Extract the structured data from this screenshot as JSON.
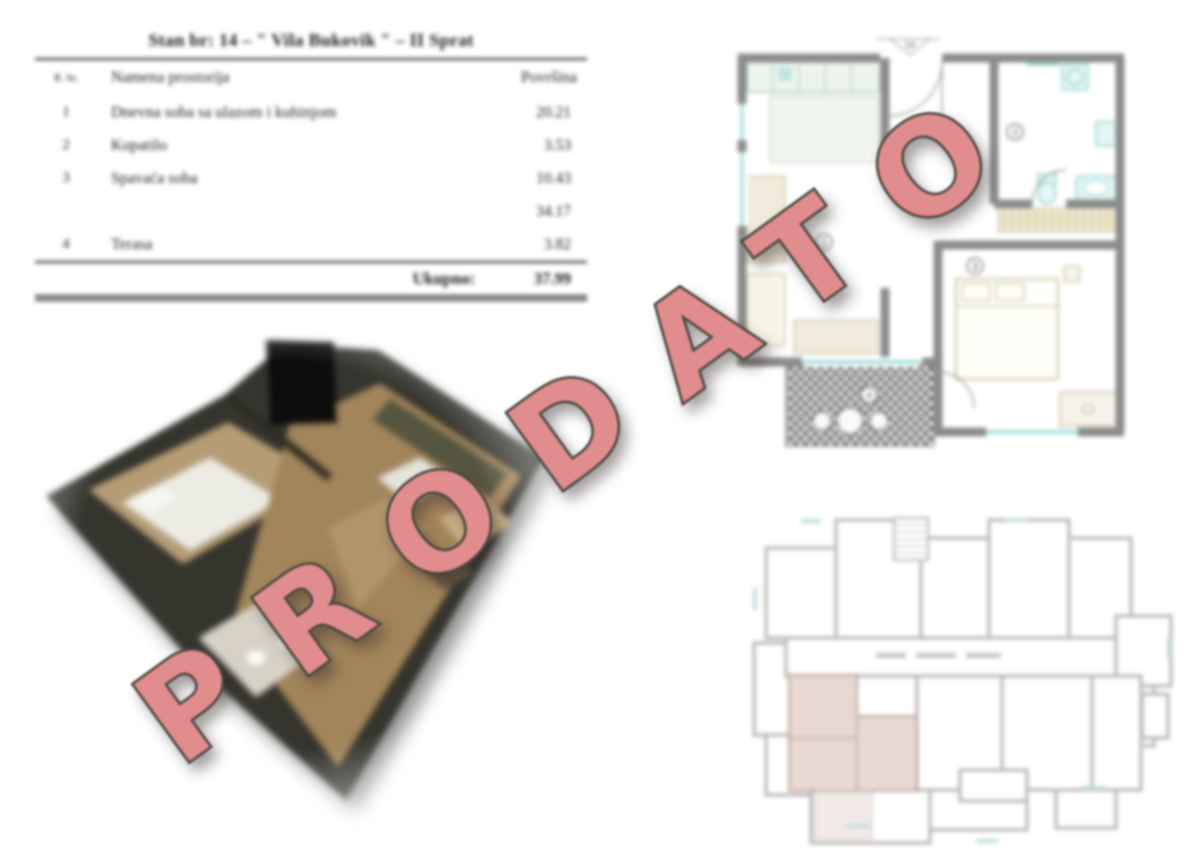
{
  "document": {
    "title": "Stan br: 14 – \" Vila Bukovik \" – II Sprat"
  },
  "table": {
    "header": {
      "col_num": "R. br.",
      "col_name": "Namena prostorija",
      "col_area": "Površina"
    },
    "rows": [
      {
        "num": "1",
        "name": "Dnevna soba sa ulazom i kuhinjom",
        "area": "20.21"
      },
      {
        "num": "2",
        "name": "Kupatilo",
        "area": "3.53"
      },
      {
        "num": "3",
        "name": "Spavaća soba",
        "area": "10.43"
      },
      {
        "num": "",
        "name": "",
        "area": "34.17"
      },
      {
        "num": "4",
        "name": "Terasa",
        "area": "3.82"
      }
    ],
    "total": {
      "label": "Ukupno:",
      "value": "37.99"
    }
  },
  "floor_plan": {
    "unit_flag": "14",
    "room_numbers": [
      "1",
      "2",
      "3",
      "4"
    ],
    "colors": {
      "walls": "#8c8c8c",
      "fixtures": "#8fd2cf"
    }
  },
  "key_plan": {
    "colors": {
      "outline": "#b6b2ae",
      "highlight": "#c49b90"
    }
  },
  "watermark": {
    "text": "PRODATO",
    "color": "#e28d8d"
  }
}
